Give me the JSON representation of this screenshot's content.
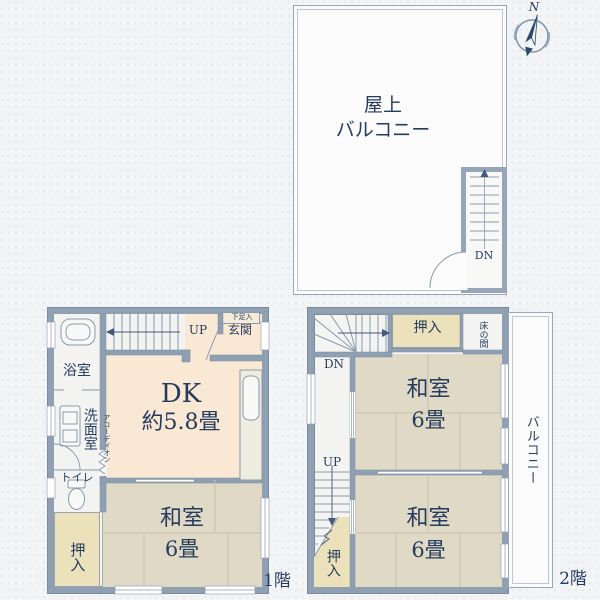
{
  "page": {
    "floor1_tag": "1階",
    "floor2_tag": "2階"
  },
  "compass": {
    "north": "N"
  },
  "rooftop": {
    "title1": "屋上",
    "title2": "バルコニー",
    "dn": "DN"
  },
  "floor1": {
    "up": "UP",
    "shoe": "下足入",
    "genkan": "玄関",
    "bath": "浴室",
    "wash": "洗面室",
    "accordion": "アコーディオン",
    "toilet": "トイレ",
    "closet": "押入",
    "dk1": "DK",
    "dk2": "約5.8畳",
    "w1": "和室",
    "w2": "6畳"
  },
  "floor2": {
    "dn": "DN",
    "up": "UP",
    "closet_top": "押入",
    "tokonoma": "床の間",
    "r1a": "和室",
    "r1b": "6畳",
    "r2a": "和室",
    "r2b": "6畳",
    "closet_bottom": "押入",
    "balcony": "バルコニー"
  },
  "colors": {
    "wall": "#8fa0b3",
    "tatami": "#dfd9c5",
    "dk_floor": "#f9e8d4",
    "closet": "#ebe1bb",
    "text_navy": "#263c5f",
    "line": "#8a99ab"
  }
}
